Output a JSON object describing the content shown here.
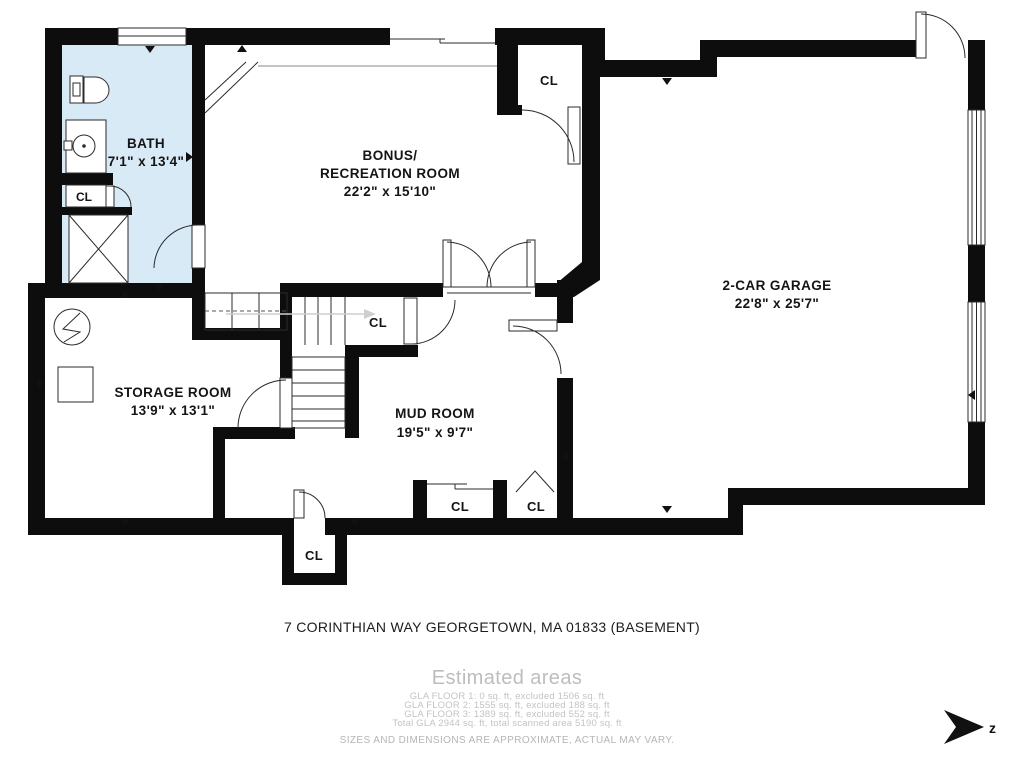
{
  "floorplan": {
    "address": "7 CORINTHIAN WAY GEORGETOWN, MA 01833 (BASEMENT)",
    "rooms": {
      "bath": {
        "name": "BATH",
        "dims": "7'1\" x 13'4\""
      },
      "bonus": {
        "name_line1": "BONUS/",
        "name_line2": "RECREATION ROOM",
        "dims": "22'2\" x 15'10\""
      },
      "garage": {
        "name": "2-CAR GARAGE",
        "dims": "22'8\" x 25'7\""
      },
      "storage": {
        "name": "STORAGE ROOM",
        "dims": "13'9\" x 13'1\""
      },
      "mud": {
        "name": "MUD ROOM",
        "dims": "19'5\" x 9'7\""
      }
    },
    "closets": {
      "bath_cl": "CL",
      "top_cl": "CL",
      "stairs_cl": "CL",
      "bottom_cl": "CL",
      "mud_cl": "CL",
      "mud_cl_right": "CL"
    },
    "compass": {
      "label": "z"
    },
    "colors": {
      "wall": "#0d0d0d",
      "bath_fill": "#d9eaf7",
      "muted_text": "#bdbdbd"
    }
  },
  "footer": {
    "estimated_title": "Estimated areas",
    "lines": [
      "GLA FLOOR 1: 0 sq. ft, excluded 1506 sq. ft",
      "GLA FLOOR 2: 1555 sq. ft, excluded 188 sq. ft",
      "GLA FLOOR 3: 1389 sq. ft, excluded 552 sq. ft",
      "Total GLA 2944 sq. ft, total scanned area 5190 sq. ft"
    ],
    "disclaimer": "SIZES AND DIMENSIONS ARE APPROXIMATE, ACTUAL MAY VARY."
  }
}
